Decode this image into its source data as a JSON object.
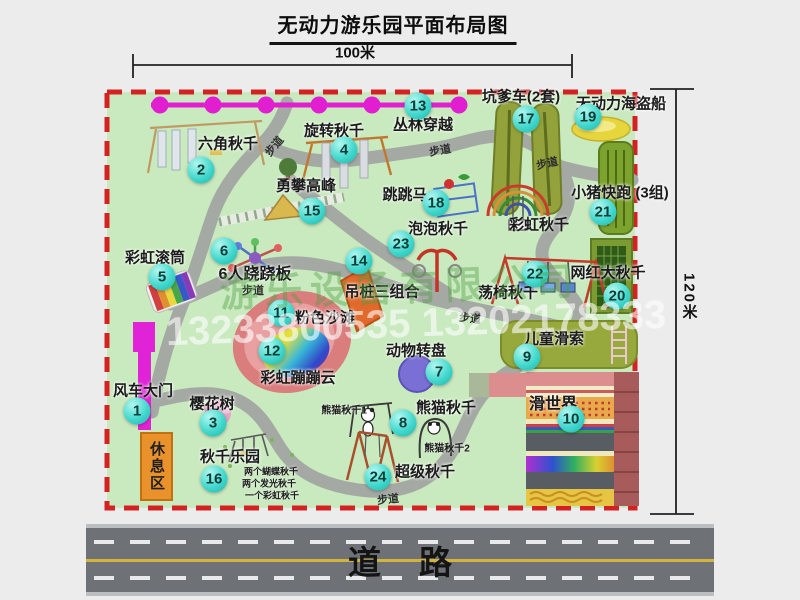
{
  "title": "无动力游乐园平面布局图",
  "dimension_labels": {
    "horizontal": "100米",
    "vertical": "120米"
  },
  "road_label": "道路",
  "rest_area_label": "休息区",
  "path_label_text": "步道",
  "path_label_instances": [
    [
      274,
      146,
      -50
    ],
    [
      440,
      150,
      -10
    ],
    [
      547,
      163,
      -12
    ],
    [
      253,
      290,
      0
    ],
    [
      470,
      318,
      6
    ],
    [
      388,
      499,
      -6
    ]
  ],
  "watermark": {
    "company_text": "游乐设备有限公司",
    "phone_text": "13233800535 13202178333"
  },
  "colors": {
    "map_green": "#c9e9bf",
    "border_red": "#d42222",
    "road_gray": "#6e7176",
    "road_yellow_line": "#d4b33c",
    "badge_teal": "#35d1c8",
    "zipline_magenta": "#e11fd0",
    "gate_magenta": "#e023d6",
    "rest_area_orange": "#e9912b",
    "path_gray": "#a5a9a4"
  },
  "attractions": [
    {
      "num": "1",
      "label": "风车大门",
      "badge": [
        137,
        411
      ],
      "label_pos": [
        143,
        390
      ]
    },
    {
      "num": "2",
      "label": "六角秋千",
      "badge": [
        201,
        170
      ],
      "label_pos": [
        228,
        143
      ]
    },
    {
      "num": "3",
      "label": "樱花树",
      "badge": [
        213,
        423
      ],
      "label_pos": [
        212,
        403
      ]
    },
    {
      "num": "4",
      "label": "旋转秋千",
      "badge": [
        344,
        150
      ],
      "label_pos": [
        334,
        130
      ]
    },
    {
      "num": "5",
      "label": "彩虹滚筒",
      "badge": [
        162,
        277
      ],
      "label_pos": [
        155,
        257
      ]
    },
    {
      "num": "6",
      "label": "6人跷跷板",
      "badge": [
        224,
        251
      ],
      "label_pos": [
        255,
        272
      ],
      "size": 16
    },
    {
      "num": "7",
      "label": "动物转盘",
      "badge": [
        439,
        372
      ],
      "label_pos": [
        416,
        350
      ]
    },
    {
      "num": "8",
      "label": "熊猫秋千",
      "badge": [
        403,
        423
      ],
      "label_pos": [
        446,
        407
      ]
    },
    {
      "num": "9",
      "label": "儿童滑索",
      "badge": [
        527,
        357
      ],
      "label_pos": [
        554,
        338
      ]
    },
    {
      "num": "10",
      "label": "滑世界",
      "badge": [
        571,
        419
      ],
      "label_pos": [
        553,
        402
      ],
      "size": 16
    },
    {
      "num": "11",
      "label": "粉色沙滩",
      "badge": [
        281,
        313
      ],
      "label_pos": [
        325,
        317
      ]
    },
    {
      "num": "12",
      "label": "彩虹蹦蹦云",
      "badge": [
        272,
        351
      ],
      "label_pos": [
        298,
        377
      ]
    },
    {
      "num": "13",
      "label": "丛林穿越",
      "badge": [
        418,
        106
      ],
      "label_pos": [
        423,
        124
      ]
    },
    {
      "num": "14",
      "label": "吊桩三组合",
      "badge": [
        359,
        261
      ],
      "label_pos": [
        382,
        291
      ]
    },
    {
      "num": "15",
      "label": "勇攀高峰",
      "badge": [
        312,
        211
      ],
      "label_pos": [
        306,
        185
      ]
    },
    {
      "num": "16",
      "label": "秋千乐园",
      "badge": [
        214,
        479
      ],
      "label_pos": [
        230,
        456
      ]
    },
    {
      "num": "17",
      "label": "坑爹车(2套)",
      "badge": [
        526,
        119
      ],
      "label_pos": [
        521,
        96
      ]
    },
    {
      "num": "18",
      "label": "跳跳马",
      "badge": [
        436,
        203
      ],
      "label_pos": [
        405,
        194
      ]
    },
    {
      "num": "19",
      "label": "无动力海盗船",
      "badge": [
        588,
        117
      ],
      "label_pos": [
        621,
        103
      ]
    },
    {
      "num": "20",
      "label": "网红大秋千",
      "badge": [
        617,
        296
      ],
      "label_pos": [
        608,
        272
      ]
    },
    {
      "num": "21",
      "label": "小猪快跑 (3组)",
      "badge": [
        603,
        212
      ],
      "label_pos": [
        620,
        192
      ]
    },
    {
      "num": "22",
      "label": "荡椅秋千",
      "badge": [
        535,
        274
      ],
      "label_pos": [
        508,
        292
      ]
    },
    {
      "num": "23",
      "label": "泡泡秋千",
      "badge": [
        401,
        244
      ],
      "label_pos": [
        438,
        228
      ]
    },
    {
      "num": "24",
      "label": "超级秋千",
      "badge": [
        378,
        477
      ],
      "label_pos": [
        425,
        471
      ]
    }
  ],
  "secondary_labels": [
    {
      "text": "彩虹秋千",
      "x": 539,
      "y": 224,
      "size": 15
    },
    {
      "text": "熊猫秋千1",
      "x": 344,
      "y": 409,
      "size": 10
    },
    {
      "text": "熊猫秋千2",
      "x": 447,
      "y": 447,
      "size": 10
    },
    {
      "text": "两个蝴蝶秋千",
      "x": 271,
      "y": 471,
      "size": 9
    },
    {
      "text": "两个发光秋千",
      "x": 269,
      "y": 483,
      "size": 9
    },
    {
      "text": "一个彩虹秋千",
      "x": 272,
      "y": 495,
      "size": 9
    }
  ]
}
